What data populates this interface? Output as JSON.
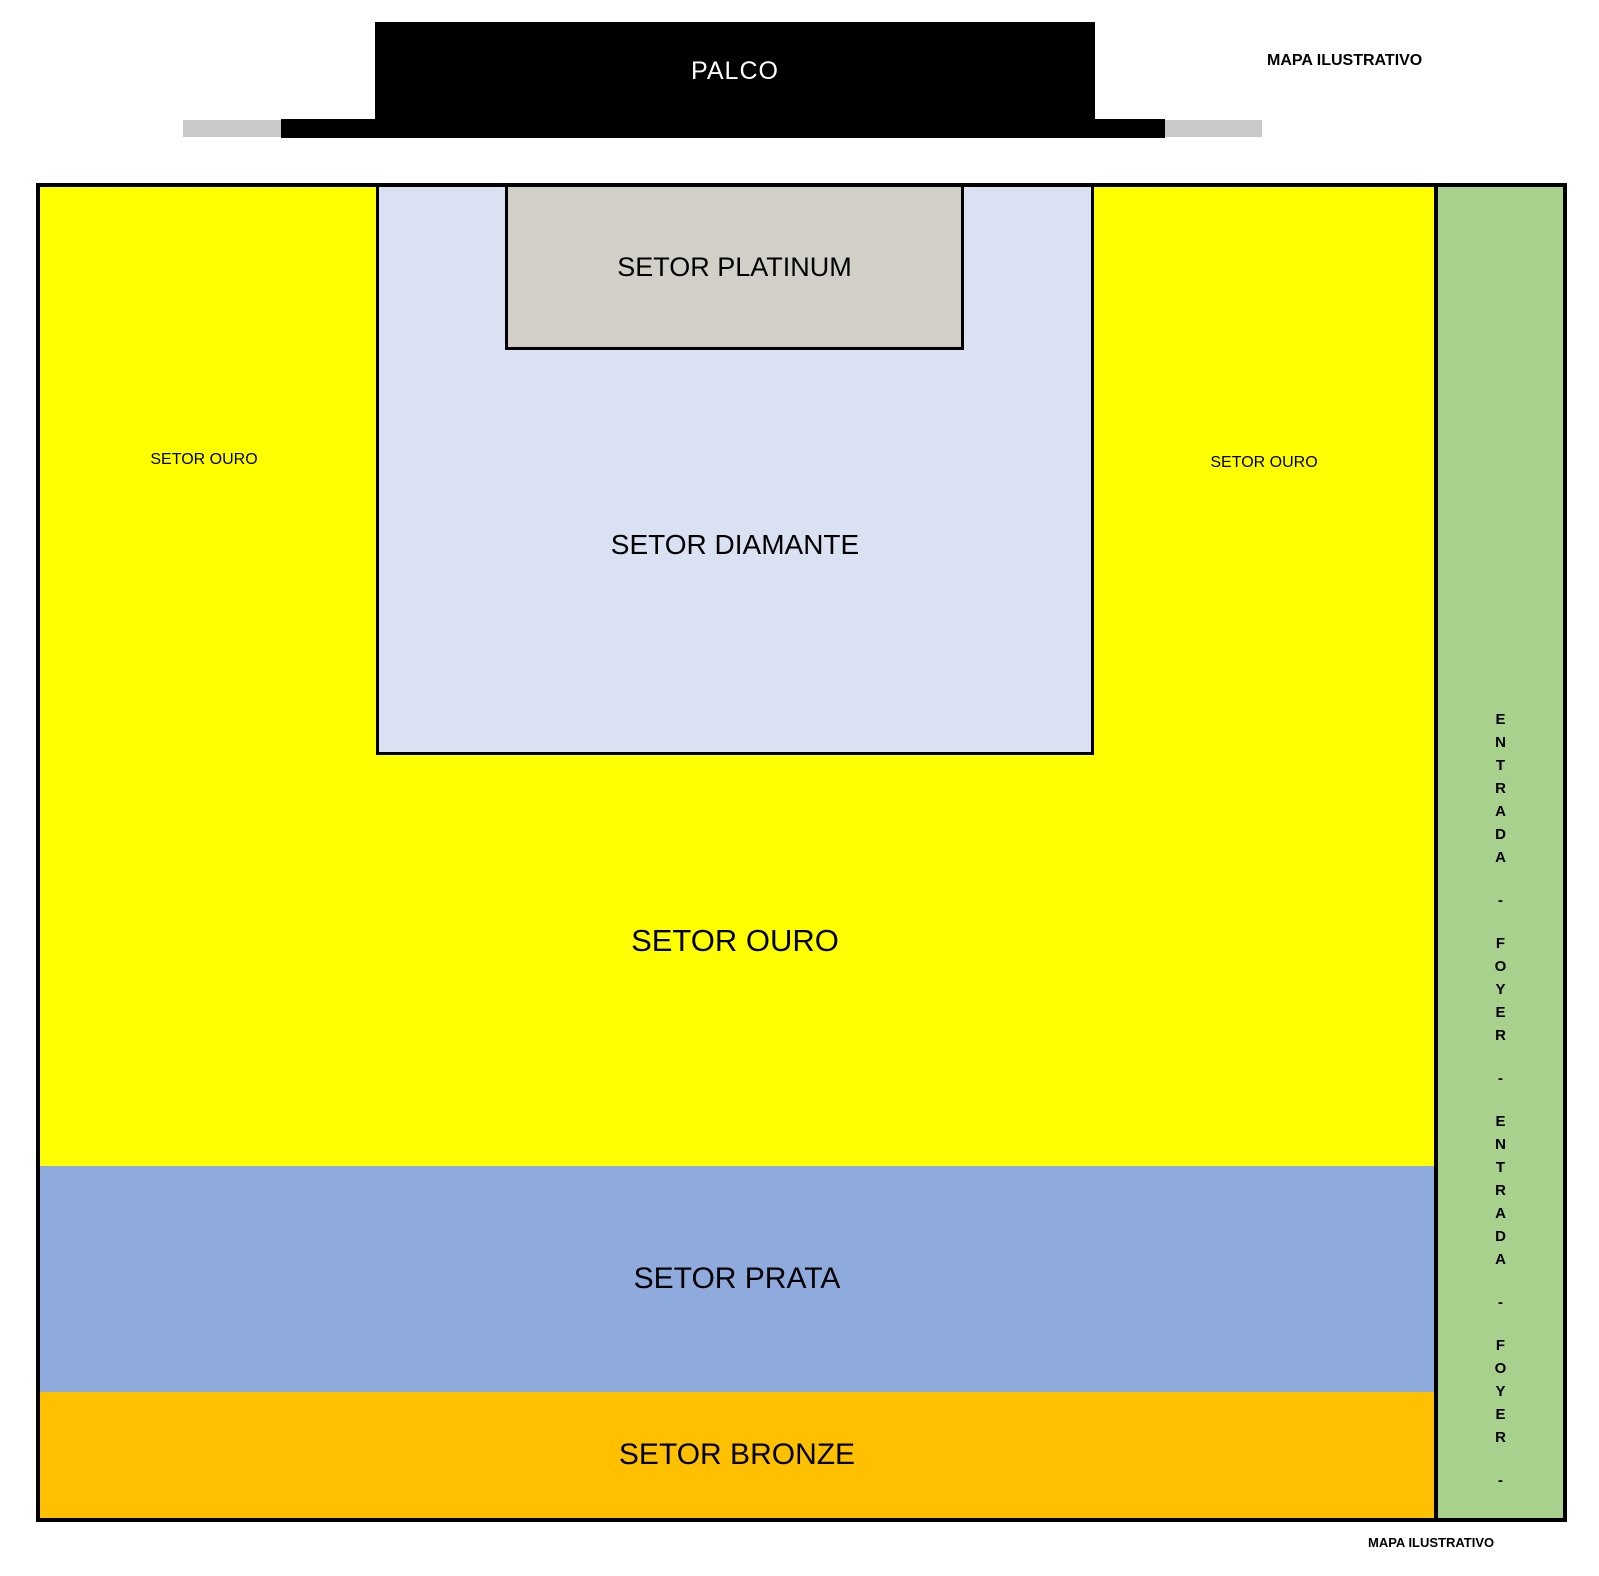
{
  "meta": {
    "watermark_top": "MAPA ILUSTRATIVO",
    "watermark_bottom": "MAPA ILUSTRATIVO"
  },
  "stage": {
    "label": "PALCO",
    "color": "#000000",
    "apron_gray_color": "#c9c9c9"
  },
  "sectors": {
    "platinum": {
      "label": "SETOR PLATINUM",
      "color": "#d2cfc9"
    },
    "diamante": {
      "label": "SETOR DIAMANTE",
      "color": "#dae1f3"
    },
    "ouro": {
      "label": "SETOR OURO",
      "color": "#ffff00"
    },
    "ouro_left": {
      "label": "SETOR OURO"
    },
    "ouro_right": {
      "label": "SETOR OURO"
    },
    "prata": {
      "label": "SETOR PRATA",
      "color": "#8faadc"
    },
    "bronze": {
      "label": "SETOR BRONZE",
      "color": "#ffc000"
    }
  },
  "entrance_strip": {
    "label": "ENTRADA - FOYER - ENTRADA - FOYER -",
    "color": "#a9d18e"
  }
}
